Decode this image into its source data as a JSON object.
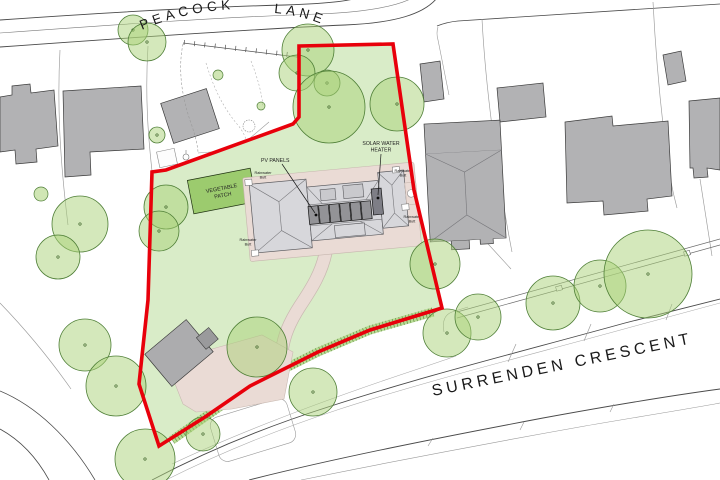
{
  "roads": {
    "peacock_lane": {
      "word1": "PEACOCK",
      "word2": "LANE"
    },
    "surrenden_crescent": {
      "label": "SURRENDEN CRESCENT"
    }
  },
  "labels": {
    "vegetable_patch_l1": "VEGETABLE",
    "vegetable_patch_l2": "PATCH",
    "pv_panels": "PV PANELS",
    "solar_water_l1": "SOLAR WATER",
    "solar_water_l2": "HEATER",
    "rainwater_l1": "Rainwater",
    "rainwater_l2": "Butt"
  },
  "colors": {
    "site_boundary": "#e8000b",
    "lawn": "#d9ecc8",
    "tree_fill": "#a9d177",
    "tree_stroke": "#4f7f37",
    "vegetable_patch": "#9ccb6e",
    "hedge_light": "#b9dc95",
    "hedge_dark": "#4b7a31",
    "building": "#b2b2b4",
    "house_roof": "#d7d7db",
    "pv_panel": "#939397",
    "paving": "#eadbd5"
  },
  "trees": [
    {
      "x": 133,
      "y": 30,
      "r": 15
    },
    {
      "x": 147,
      "y": 42,
      "r": 19
    },
    {
      "x": 157,
      "y": 135,
      "r": 8
    },
    {
      "x": 308,
      "y": 50,
      "r": 26
    },
    {
      "x": 297,
      "y": 73,
      "r": 18
    },
    {
      "x": 327,
      "y": 83,
      "r": 13
    },
    {
      "x": 329,
      "y": 107,
      "r": 36
    },
    {
      "x": 397,
      "y": 104,
      "r": 27
    },
    {
      "x": 80,
      "y": 224,
      "r": 28
    },
    {
      "x": 58,
      "y": 257,
      "r": 22
    },
    {
      "x": 166,
      "y": 207,
      "r": 22
    },
    {
      "x": 159,
      "y": 231,
      "r": 20
    },
    {
      "x": 85,
      "y": 345,
      "r": 26
    },
    {
      "x": 116,
      "y": 386,
      "r": 30
    },
    {
      "x": 145,
      "y": 459,
      "r": 30
    },
    {
      "x": 203,
      "y": 434,
      "r": 17
    },
    {
      "x": 257,
      "y": 347,
      "r": 30
    },
    {
      "x": 313,
      "y": 392,
      "r": 24
    },
    {
      "x": 435,
      "y": 264,
      "r": 25
    },
    {
      "x": 447,
      "y": 333,
      "r": 24
    },
    {
      "x": 478,
      "y": 317,
      "r": 23
    },
    {
      "x": 553,
      "y": 303,
      "r": 27
    },
    {
      "x": 600,
      "y": 286,
      "r": 26
    },
    {
      "x": 648,
      "y": 274,
      "r": 44
    }
  ],
  "shrubs": [
    {
      "x": 218,
      "y": 75,
      "r": 5
    },
    {
      "x": 261,
      "y": 106,
      "r": 4
    },
    {
      "x": 41,
      "y": 194,
      "r": 7
    }
  ]
}
